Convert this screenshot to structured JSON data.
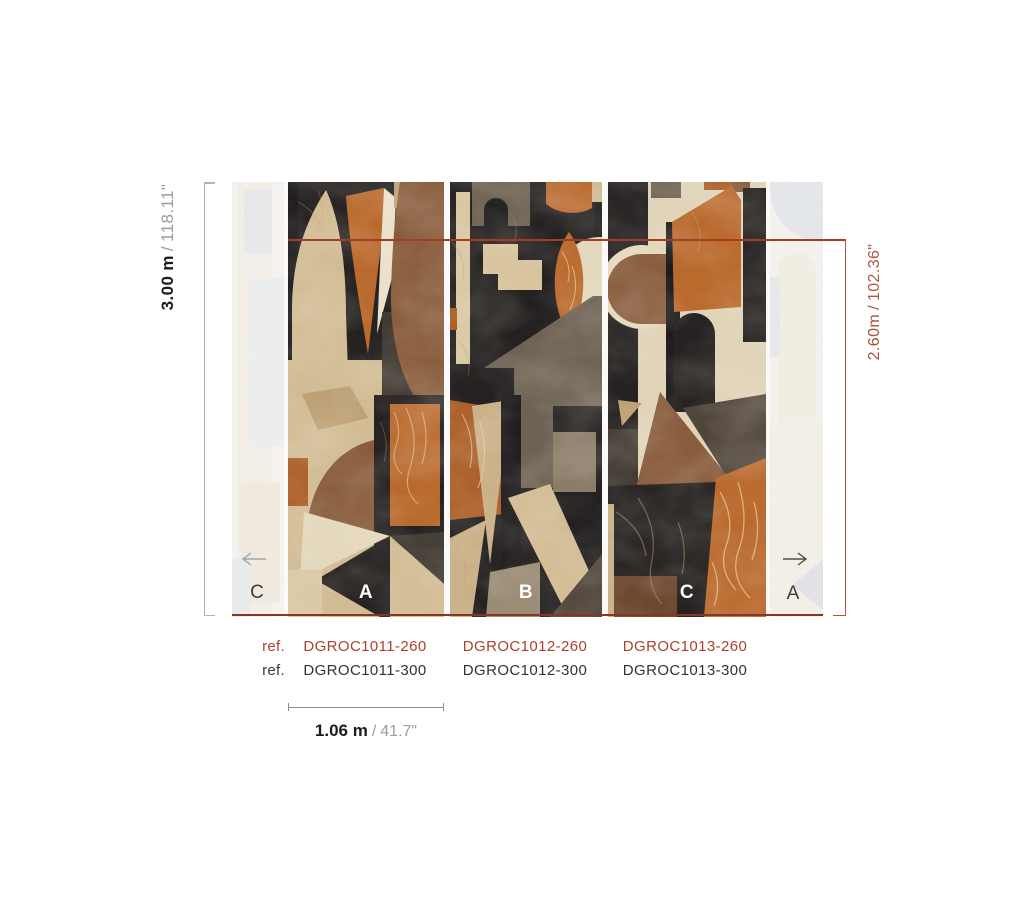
{
  "sheet": {
    "background": "#ffffff",
    "accent_red": "#a8422f",
    "dimension_red": "#a8503b",
    "text_dark": "#1c1c1c",
    "text_gray": "#9c9c9c"
  },
  "dimensions": {
    "height_total": {
      "metric": "3.00 m",
      "sep": "/",
      "imperial": "118.11\""
    },
    "height_partial": {
      "metric": "2.60m",
      "sep": "/",
      "imperial": "102.36\""
    },
    "panel_width": {
      "metric": "1.06 m",
      "sep": "/",
      "imperial": "41.7\""
    }
  },
  "panels": {
    "faded_left": "C",
    "main": [
      {
        "label": "A"
      },
      {
        "label": "B"
      },
      {
        "label": "C"
      }
    ],
    "faded_right": "A"
  },
  "icons": {
    "left": "arrow-left",
    "right": "arrow-right"
  },
  "references": {
    "rows": [
      {
        "label": "ref.",
        "codes": [
          "DGROC1011-260",
          "DGROC1012-260",
          "DGROC1013-260"
        ]
      },
      {
        "label": "ref.",
        "codes": [
          "DGROC1011-300",
          "DGROC1012-300",
          "DGROC1013-300"
        ]
      }
    ]
  }
}
